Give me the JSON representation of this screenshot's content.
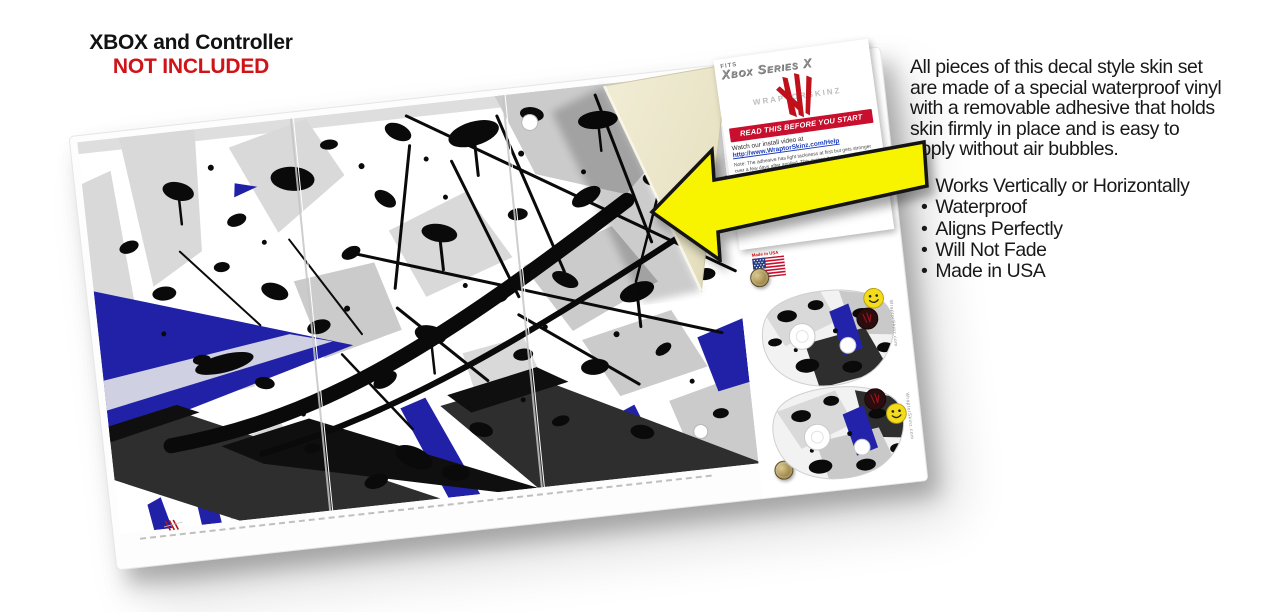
{
  "notice": {
    "line1": "XBOX and Controller",
    "line2": "NOT INCLUDED"
  },
  "description": {
    "lines": [
      "All pieces of this decal style skin set",
      "are made of a special waterproof vinyl",
      "with a removable adhesive that holds",
      "skin firmly in place and is easy to",
      "apply without air bubbles."
    ]
  },
  "features": [
    "Works Vertically or Horizontally",
    "Waterproof",
    "Aligns Perfectly",
    "Will Not Fade",
    "Made in USA"
  ],
  "instruction_card": {
    "fits": "FITS",
    "model": "Xbox Series X",
    "brand": "WRAPTORSKINZ",
    "banner": "READ THIS BEFORE YOU START",
    "watch_line": "Watch our install video at",
    "link": "http://www.WraptorSkinz.com/Help",
    "note1": "Note: The adhesive has light tackiness at first but gets stronger over a few days after applied. This makes it easier to adjust and reposition the skin during application.",
    "note2": "…e you are about to apply the skin to picture … application heat the skin with a …"
  },
  "sheet": {
    "flag_label": "Made in USA",
    "edge_text": "WraptorSkinz.com"
  },
  "colors": {
    "accent_red": "#cf1318",
    "banner_red": "#c8102e",
    "arrow_yellow": "#f8f400",
    "splatter_blue": "#2121a8",
    "charcoal": "#2e2e2e",
    "backing_cream": "#ece7cb"
  }
}
